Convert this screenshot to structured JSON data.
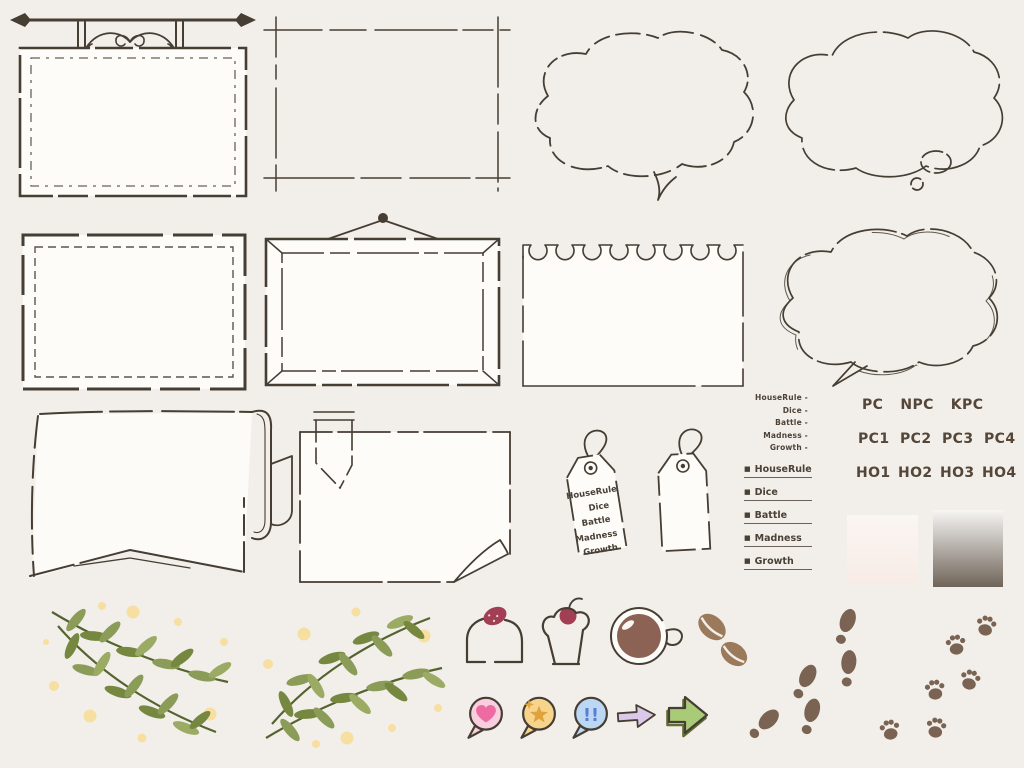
{
  "palette": {
    "background": "#f2efea",
    "ink": "#463d33",
    "board_fill": "#fdfcf9",
    "text_brown": "#4e4237",
    "leaf_green": "#8b9c58",
    "dot_yellow": "#f6dfa1",
    "berry_red": "#a23f55",
    "coffee_brown": "#8b6253",
    "bean_tan": "#9b7a5b",
    "heart_pink": "#ee6ba2",
    "heart_bubble": "#f9cfdf",
    "star_orange": "#dfa23d",
    "star_bubble": "#f6d48c",
    "exclaim_blue": "#5a7fd2",
    "exclaim_bubble": "#bcd7f3",
    "purple_arrow": "#dcc9ea",
    "green_arrow": "#a9ca77",
    "print_brown": "#7a6353"
  },
  "tag": {
    "lines": [
      "HouseRule",
      "Dice",
      "Battle",
      "Madness",
      "Growth"
    ]
  },
  "dash_list": {
    "items": [
      "HouseRule -",
      "Dice -",
      "Battle -",
      "Madness -",
      "Growth -"
    ]
  },
  "bullet_list": {
    "bullet": "■",
    "items": [
      "HouseRule",
      "Dice",
      "Battle",
      "Madness",
      "Growth"
    ]
  },
  "labels": {
    "row1": [
      "PC",
      "NPC",
      "KPC"
    ],
    "row2": [
      "PC1",
      "PC2",
      "PC3",
      "PC4"
    ],
    "row3": [
      "HO1",
      "HO2",
      "HO3",
      "HO4"
    ]
  },
  "speech_icons": {
    "exclaim": "!!"
  },
  "swatches": [
    {
      "name": "paper-white-gradient",
      "from": "#faf6f3",
      "to": "#f8ebe6"
    },
    {
      "name": "brown-gradient",
      "from": "#f7f6f4",
      "to": "#6f6459"
    }
  ],
  "decorations": [
    "hanging-sign-board",
    "trim-mark-frame",
    "dashed-cloud-bubble",
    "thought-cloud-bubble",
    "stitched-frame",
    "hanging-picture-frame",
    "torn-notebook-paper",
    "double-line-cloud-bubble",
    "swallowtail-banner",
    "paper-with-ribbon-bookmark",
    "hang-tag-labeled",
    "hang-tag-blank",
    "olive-branch-left",
    "olive-branch-right",
    "strawberry-cake",
    "cherry-cupcake",
    "coffee-cup-top",
    "coffee-beans",
    "heart-speech-icon",
    "star-speech-icon",
    "exclaim-speech-icon",
    "purple-arrow",
    "green-arrow",
    "shoe-footprints",
    "paw-prints"
  ]
}
